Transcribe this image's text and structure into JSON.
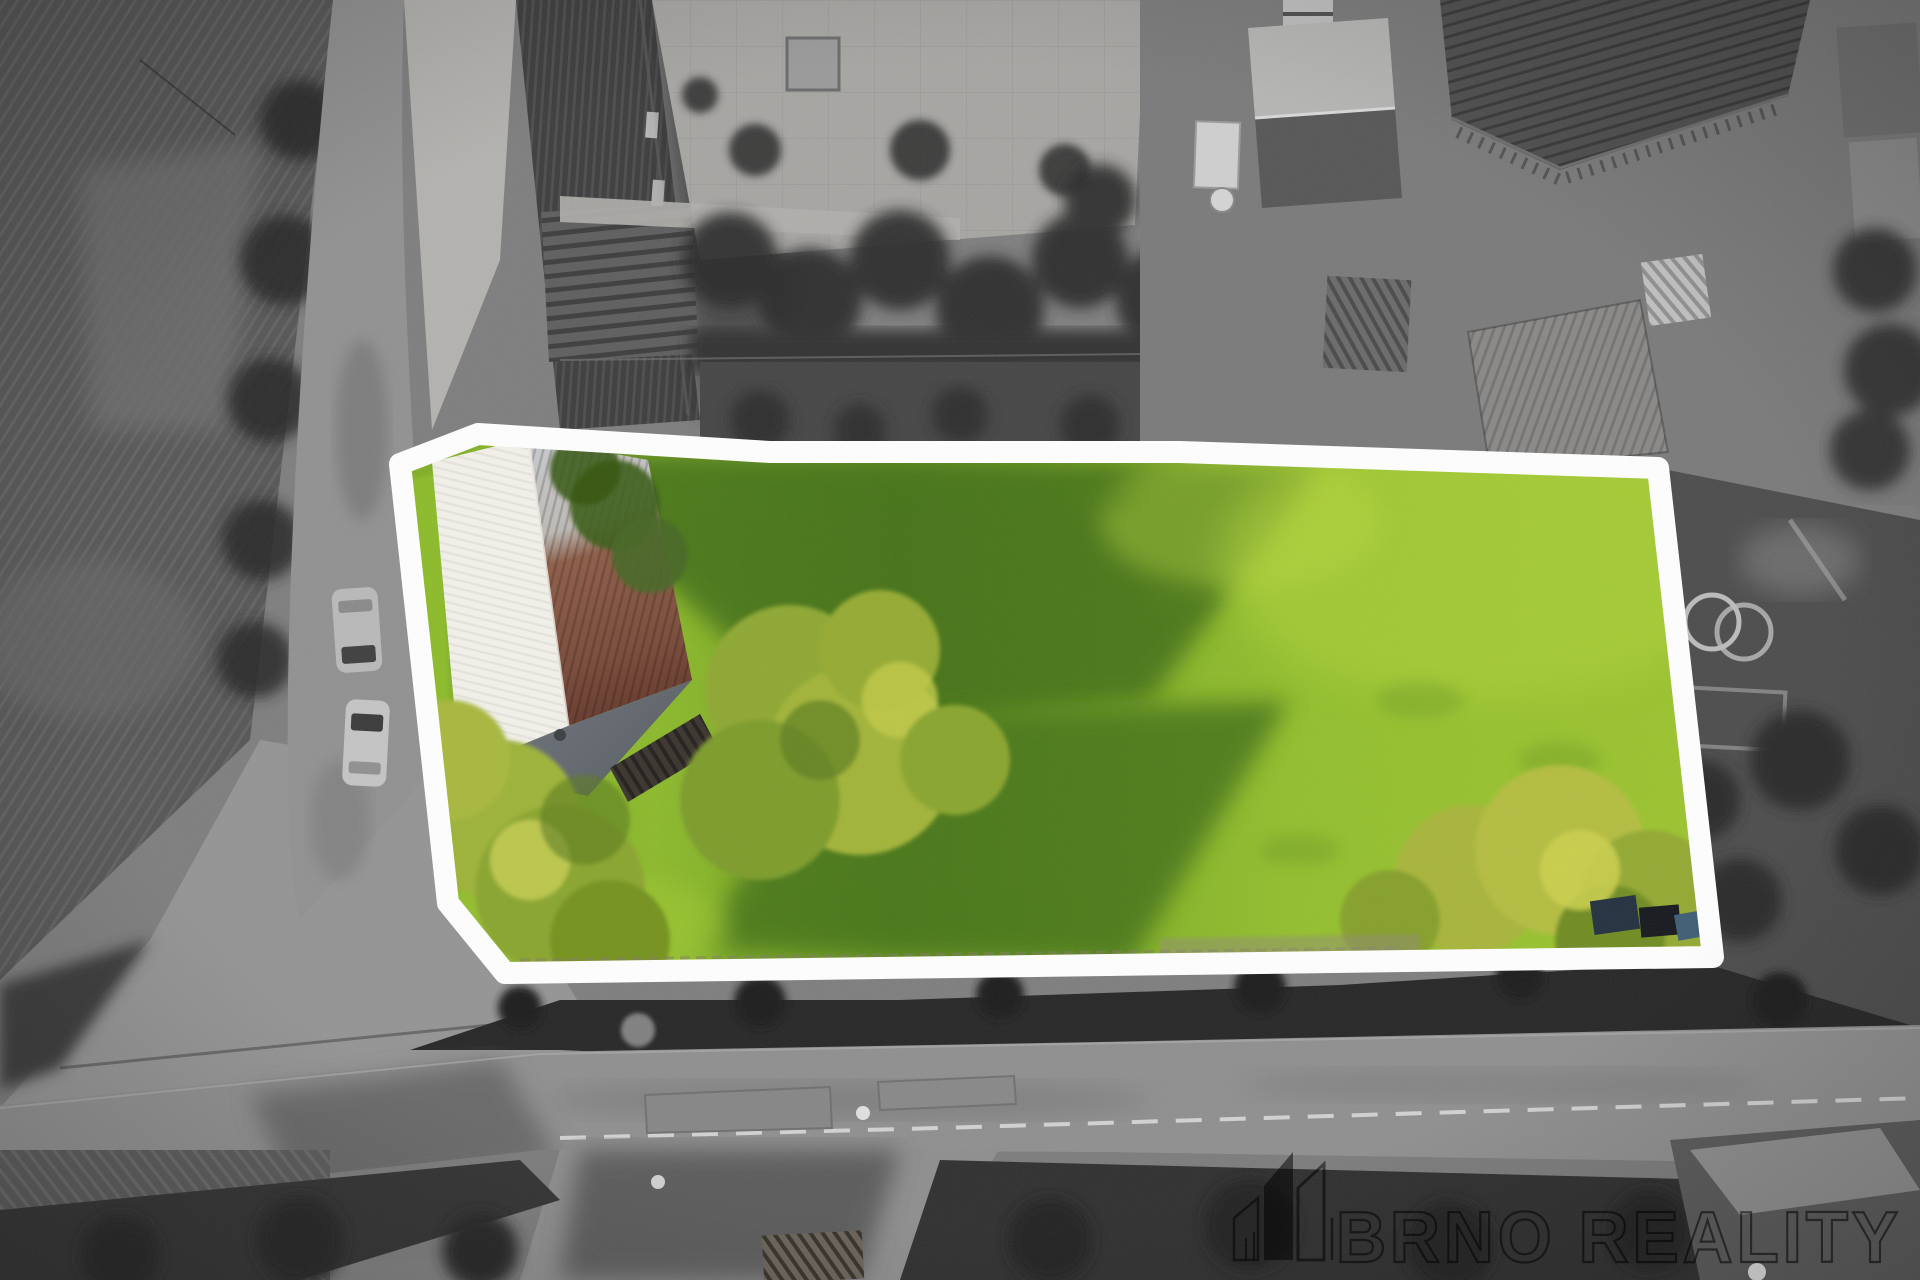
{
  "scene": {
    "kind": "aerial-drone-photograph",
    "treatment": "surroundings desaturated to grayscale; offered land plot shown in color inside a white boundary outline"
  },
  "plot": {
    "outline_color": "#ffffff",
    "lawn_sunlit": "#9cc42f",
    "lawn_mid": "#7fae26",
    "lawn_shaded": "#3f6b18",
    "roof_white": "#f3f1ea",
    "roof_metal": "#c7c8ca",
    "roof_rust": "#7a4b39",
    "roof_hip": "#5b6167"
  },
  "surroundings": {
    "asphalt": "#8f8f8f",
    "gravel": "#b3b2af",
    "field": "#565656",
    "hedge": "#262626",
    "barn_roof": "#3d3d3d"
  },
  "watermark": {
    "brand": "BRNO REALITY",
    "icon": "buildings-logo-icon",
    "color": "rgba(0,0,0,0.62)"
  }
}
